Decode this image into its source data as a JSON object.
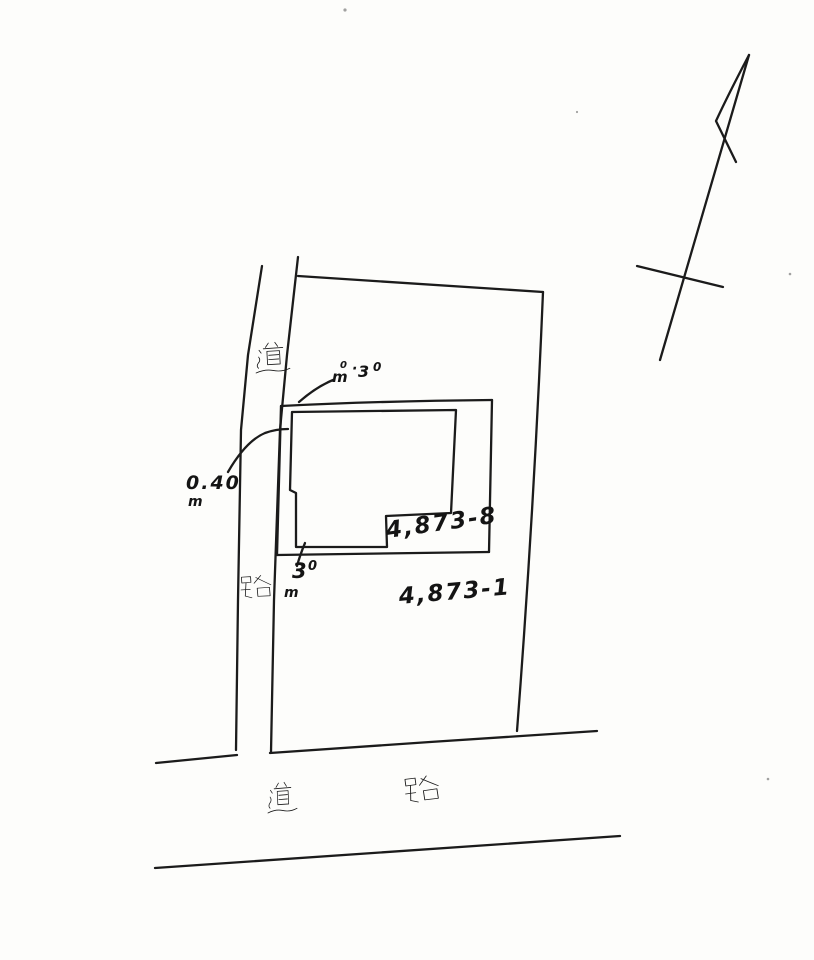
{
  "colors": {
    "paper": "#fdfdfb",
    "ink": "#1b1b1b"
  },
  "parcels": {
    "sub_lot_number": "4,873-8",
    "main_lot_number": "4,873-1"
  },
  "roads": {
    "vertical_road_char_top": "道",
    "vertical_road_char_bottom": "路",
    "bottom_road_char_left": "道",
    "bottom_road_char_right": "路"
  },
  "dimensions": {
    "top_gap": {
      "d0": "0",
      "unit": "m",
      "dot": "·",
      "d1": "3",
      "d2": "0"
    },
    "left_gap": {
      "value": "0.40",
      "unit": "m"
    },
    "bottom_gap": {
      "d1": "3",
      "d2": "0",
      "unit": "m"
    }
  },
  "icons": {
    "north_arrow": "north-arrow"
  }
}
